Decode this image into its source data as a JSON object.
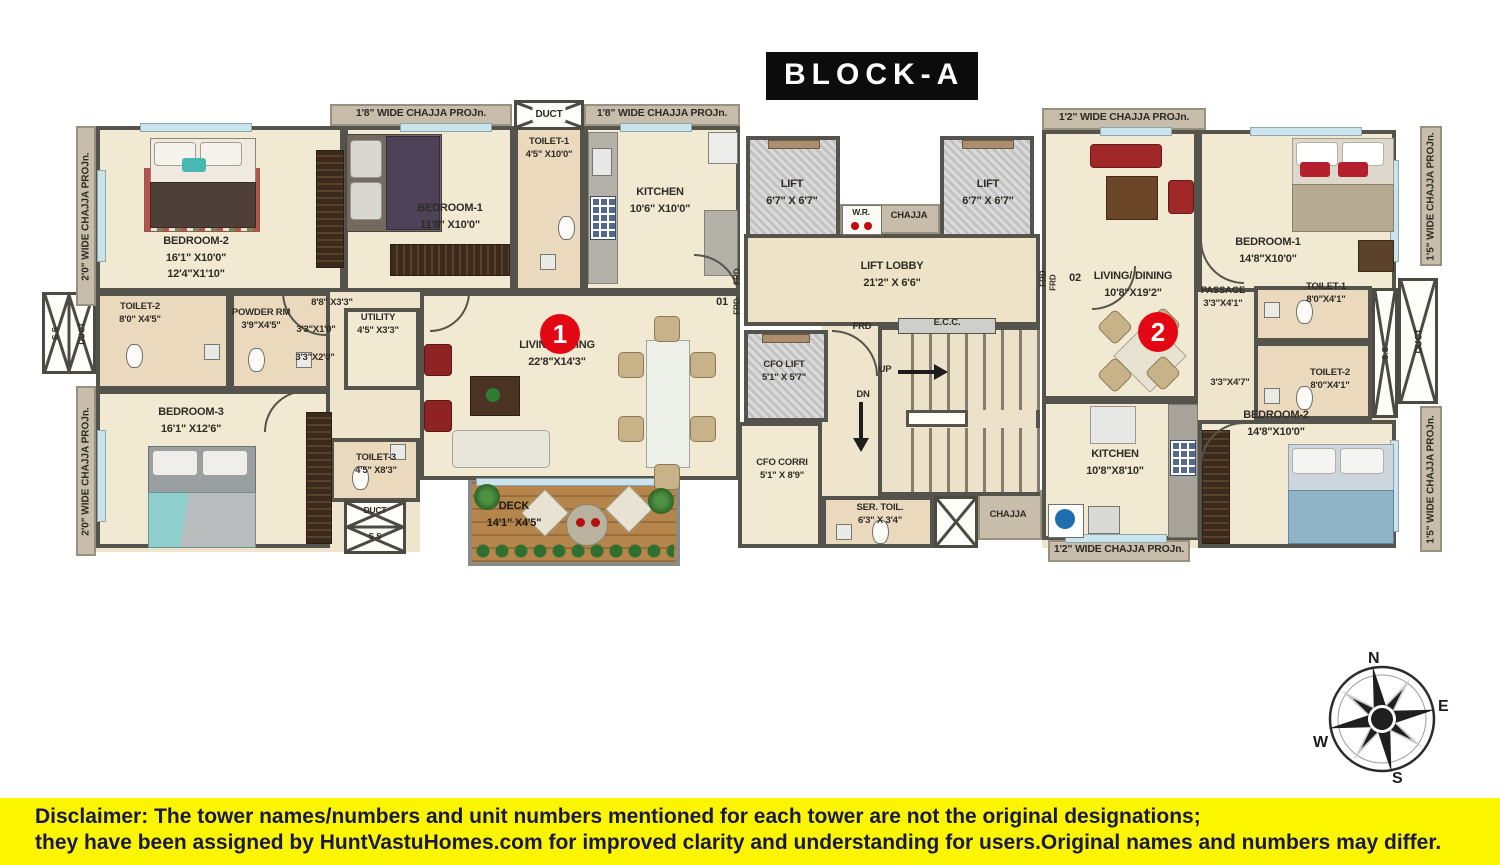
{
  "title": "BLOCK-A",
  "colors": {
    "accent_red": "#e30713",
    "wall": "#55544c",
    "floor": "#f2e9d3",
    "chajja_strip": "#c8bdaa",
    "deck_wood": "#b5854b",
    "disclaimer_bg": "#fcf500",
    "disclaimer_text": "#18184e"
  },
  "chajja": {
    "w20": "2'0\" WIDE CHAJJA PROJn.",
    "w18": "1'8\" WIDE CHAJJA PROJn.",
    "w12": "1'2\" WIDE CHAJJA PROJn.",
    "w15": "1'5\" WIDE CHAJJA PROJn.",
    "chajja": "CHAJJA"
  },
  "misc": {
    "duct": "DUCT",
    "ss": "S.S",
    "frd": "FRD",
    "wr": "W.R.",
    "ecc": "E.C.C.",
    "up": "UP",
    "dn": "DN",
    "door1": "01",
    "door2": "02"
  },
  "unit1": {
    "badge": "1",
    "living": {
      "name": "LIVING/DINING",
      "dim": "22'8\"X14'3\""
    },
    "bedroom1": {
      "name": "BEDROOM-1",
      "dim": "11'8\" X10'0\""
    },
    "bedroom2": {
      "name": "BEDROOM-2",
      "dim1": "16'1\" X10'0\"",
      "dim2": "12'4\"X1'10\""
    },
    "bedroom3": {
      "name": "BEDROOM-3",
      "dim": "16'1\" X12'6\""
    },
    "toilet1": {
      "name": "TOILET-1",
      "dim": "4'5\" X10'0\""
    },
    "toilet2": {
      "name": "TOILET-2",
      "dim": "8'0\" X4'5\""
    },
    "toilet3": {
      "name": "TOILET-3",
      "dim": "4'5\" X8'3\""
    },
    "kitchen": {
      "name": "KITCHEN",
      "dim": "10'6\" X10'0\""
    },
    "powder": {
      "name": "POWDER RM",
      "dim": "3'9\"X4'5\""
    },
    "utility": {
      "name": "UTILITY",
      "dim": "4'5\" X3'3\""
    },
    "corridor": "8'8\" X3'3\"",
    "dim_a": "3'3\"X1'0\"",
    "dim_b": "3'3\"X2'0\"",
    "deck": {
      "name": "DECK",
      "dim": "14'1\" X4'5\""
    }
  },
  "core": {
    "lift": {
      "name": "LIFT",
      "dim": "6'7\" X 6'7\""
    },
    "lobby": {
      "name": "LIFT LOBBY",
      "dim": "21'2\" X 6'6\""
    },
    "cfolift": {
      "name": "CFO LIFT",
      "dim": "5'1\" X 5'7\""
    },
    "cfocorri": {
      "name": "CFO CORRI",
      "dim": "5'1\" X 8'9\""
    },
    "sertoil": {
      "name": "SER. TOIL.",
      "dim": "6'3\" X 3'4\""
    }
  },
  "unit2": {
    "badge": "2",
    "living": {
      "name": "LIVING/ DINING",
      "dim": "10'8\"X19'2\""
    },
    "bedroom1": {
      "name": "BEDROOM-1",
      "dim": "14'8\"X10'0\""
    },
    "bedroom2": {
      "name": "BEDROOM-2",
      "dim": "14'8\"X10'0\""
    },
    "toilet1": {
      "name": "TOILET-1",
      "dim": "8'0\"X4'1\""
    },
    "toilet2": {
      "name": "TOILET-2",
      "dim": "8'0\"X4'1\""
    },
    "passage": {
      "name": "PASSAGE",
      "dim": "3'3\"X4'1\""
    },
    "kitchen": {
      "name": "KITCHEN",
      "dim": "10'8\"X8'10\""
    },
    "dim_a": "3'3\"X4'7\""
  },
  "compass": {
    "n": "N",
    "e": "E",
    "s": "S",
    "w": "W"
  },
  "disclaimer": {
    "label": "Disclaimer:",
    "line1": " The tower names/numbers and unit numbers mentioned for each tower are not the original designations;",
    "line2": "they have been assigned by HuntVastuHomes.com for improved clarity and understanding for users.Original names and numbers may differ."
  }
}
